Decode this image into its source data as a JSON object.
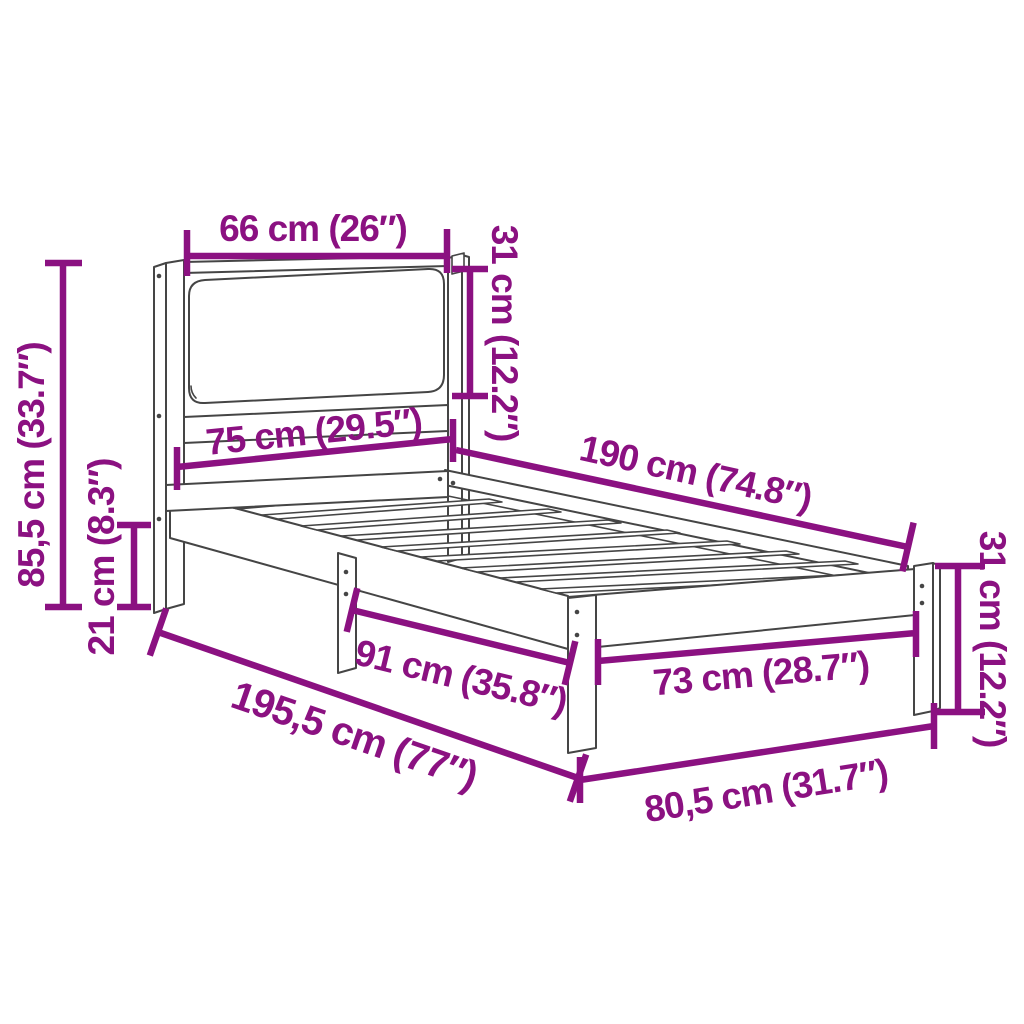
{
  "diagram": {
    "type": "product-dimension-diagram",
    "subject": "bed-frame-with-upholstered-headboard",
    "background_color": "#ffffff",
    "line_color": "#454545",
    "dimension_color": "#8b1181",
    "unit_system": "cm-and-inches",
    "dimensions": [
      {
        "id": "headboard-cushion-width",
        "label": "66 cm (26″)",
        "value_cm": 66,
        "value_in": 26
      },
      {
        "id": "headboard-cushion-height",
        "label": "31 cm (12.2″)",
        "value_cm": 31,
        "value_in": 12.2
      },
      {
        "id": "headboard-total-height",
        "label": "85,5 cm (33.7″)",
        "value_cm": 85.5,
        "value_in": 33.7
      },
      {
        "id": "frame-ground-clearance",
        "label": "21 cm (8.3″)",
        "value_cm": 21,
        "value_in": 8.3
      },
      {
        "id": "headboard-width",
        "label": "75 cm (29.5″)",
        "value_cm": 75,
        "value_in": 29.5
      },
      {
        "id": "inner-length",
        "label": "190 cm (74.8″)",
        "value_cm": 190,
        "value_in": 74.8
      },
      {
        "id": "leg-spacing",
        "label": "91 cm (35.8″)",
        "value_cm": 91,
        "value_in": 35.8
      },
      {
        "id": "total-length",
        "label": "195,5 cm (77″)",
        "value_cm": 195.5,
        "value_in": 77
      },
      {
        "id": "foot-inner-width",
        "label": "73 cm (28.7″)",
        "value_cm": 73,
        "value_in": 28.7
      },
      {
        "id": "total-width",
        "label": "80,5 cm (31.7″)",
        "value_cm": 80.5,
        "value_in": 31.7
      },
      {
        "id": "foot-end-height",
        "label": "31 cm (12.2″)",
        "value_cm": 31,
        "value_in": 12.2
      }
    ]
  }
}
